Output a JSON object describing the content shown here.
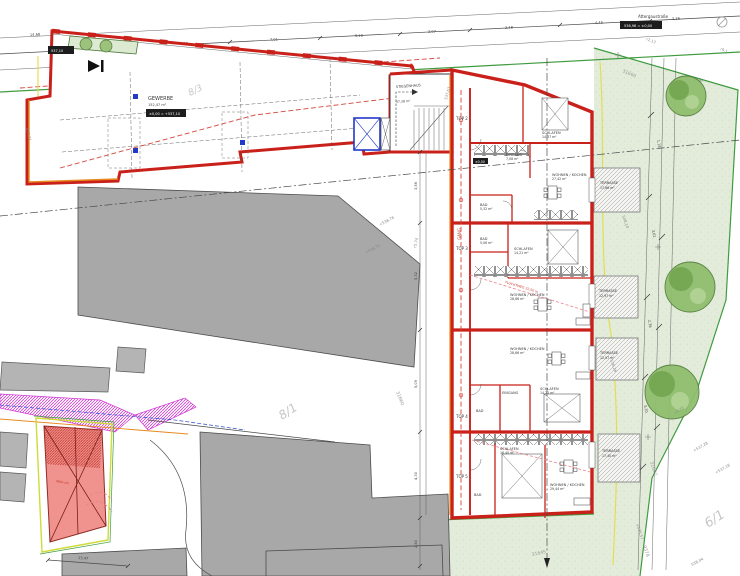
{
  "street": {
    "name": "Attergaustraße",
    "badge": "536,98 = ±0,00",
    "bauflucht": "Baufluchtlinie"
  },
  "parcels": {
    "p81": "8/1",
    "p83": "8/3",
    "p61": "6/1"
  },
  "survey": [
    "31660",
    "31660",
    "31657",
    "9378",
    "31645"
  ],
  "elevations": [
    "+538,76",
    "+538,75",
    "537,63",
    "+537,28",
    "+537,18",
    "538,04",
    "538,10",
    "538,26",
    "+536,57",
    "537,31"
  ],
  "radii": [
    "r2,13",
    "r9,1",
    "r5,74",
    "r7,72"
  ],
  "gewerbe": {
    "name": "GEWERBE",
    "area": "152,47 m²",
    "badge": "±0,00 = +537,10",
    "corner_badge": "537,10"
  },
  "stair": {
    "name": "STIEGENHAUS",
    "area": "37,38 m²"
  },
  "corridor": {
    "name": "GANG",
    "badge": "±0,00",
    "escape": "FLUCHTWEG 22,50 m"
  },
  "units": [
    {
      "id": "TOP 2",
      "rooms": [
        {
          "n": "SCHLAFEN",
          "a": "14,37 m²"
        },
        {
          "n": "EINGANG",
          "a": "7,08 m²"
        },
        {
          "n": "WOHNEN / KOCHEN",
          "a": "27,42 m²"
        },
        {
          "n": "BAD",
          "a": "5,32 m²"
        }
      ]
    },
    {
      "id": "TOP 3",
      "rooms": [
        {
          "n": "BAD",
          "a": "5,06 m²"
        },
        {
          "n": "SCHLAFEN",
          "a": "14,21 m²"
        },
        {
          "n": "WOHNEN / KOCHEN",
          "a": "28,66 m²"
        }
      ]
    },
    {
      "id": "TOP 4",
      "rooms": [
        {
          "n": "WOHNEN / KOCHEN",
          "a": "28,66 m²"
        },
        {
          "n": "EINGANG",
          "a": "6,90 m²"
        },
        {
          "n": "BAD",
          "a": "5,06 m²"
        },
        {
          "n": "SCHLAFEN",
          "a": "14,21 m²"
        }
      ]
    },
    {
      "id": "TOP 5",
      "rooms": [
        {
          "n": "SCHLAFEN",
          "a": "16,40 m²"
        },
        {
          "n": "WOHNEN / KOCHEN",
          "a": "29,44 m²"
        },
        {
          "n": "BAD",
          "a": "5,18 m²"
        }
      ]
    }
  ],
  "terraces": [
    {
      "n": "TERRASSE",
      "a": "17,66 m²"
    },
    {
      "n": "TERRASSE",
      "a": "12,97 m²"
    },
    {
      "n": "TERRASSE",
      "a": "12,97 m²"
    },
    {
      "n": "TERRASSE",
      "a": "17,40 m²"
    }
  ],
  "dims": {
    "top": [
      "5,36",
      "2,38",
      "7,01",
      "5,10",
      "2,07",
      "2,48",
      "4,45",
      "3,36"
    ],
    "left": [
      "3,56",
      "5,32",
      "5,09",
      "4,30",
      "2,40"
    ],
    "right": [
      "1,18",
      "3,61",
      "2,36",
      "3,20"
    ],
    "bottom": [
      "13,47"
    ],
    "topleft": "14,68"
  },
  "inset": {
    "abbruch": "Abbruch"
  }
}
